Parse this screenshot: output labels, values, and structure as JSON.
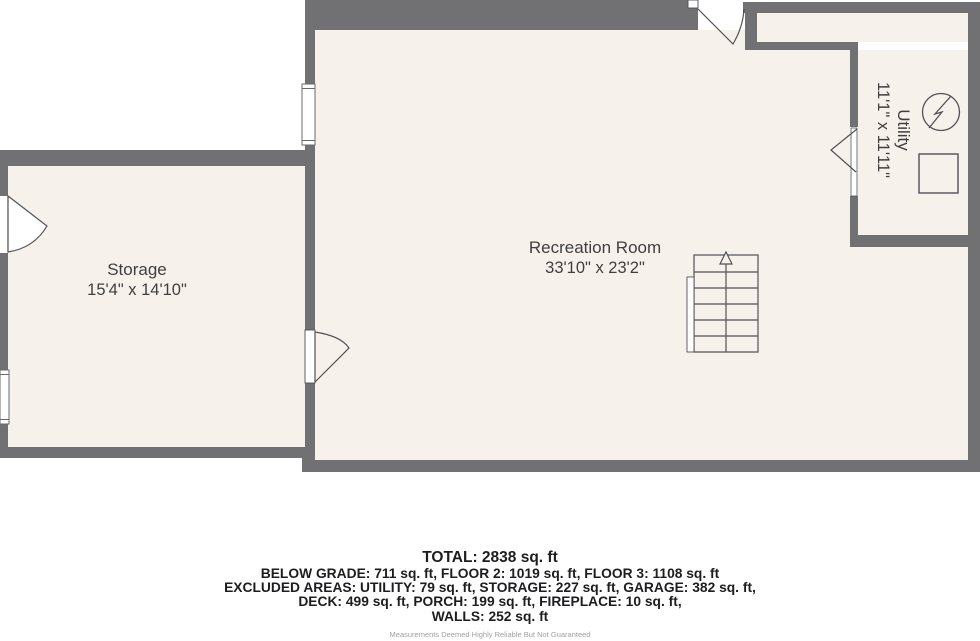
{
  "rooms": [
    {
      "name": "Storage",
      "dimensions": "15'4\" x 14'10\""
    },
    {
      "name": "Recreation Room",
      "dimensions": "33'10\" x 23'2\""
    },
    {
      "name": "Utility",
      "dimensions": "11'1\" x 11'11\""
    }
  ],
  "summary": {
    "total": "TOTAL: 2838 sq. ft",
    "lines": [
      "BELOW GRADE: 711 sq. ft, FLOOR 2: 1019 sq. ft, FLOOR 3: 1108 sq. ft",
      "EXCLUDED AREAS: UTILITY: 79 sq. ft, STORAGE: 227 sq. ft, GARAGE: 382 sq. ft,",
      "DECK: 499 sq. ft, PORCH: 199 sq. ft, FIREPLACE: 10 sq. ft,",
      "WALLS: 252 sq. ft"
    ],
    "disclaimer": "Measurements Deemed Highly Reliable But Not Guaranteed"
  },
  "colors": {
    "wall": "#717174",
    "floor": "#f6f1ea",
    "symbol_stroke": "#515156",
    "label_text": "#3f3f41",
    "summary_text": "#1d1d20",
    "disclaimer_text": "#a1a1a1"
  }
}
